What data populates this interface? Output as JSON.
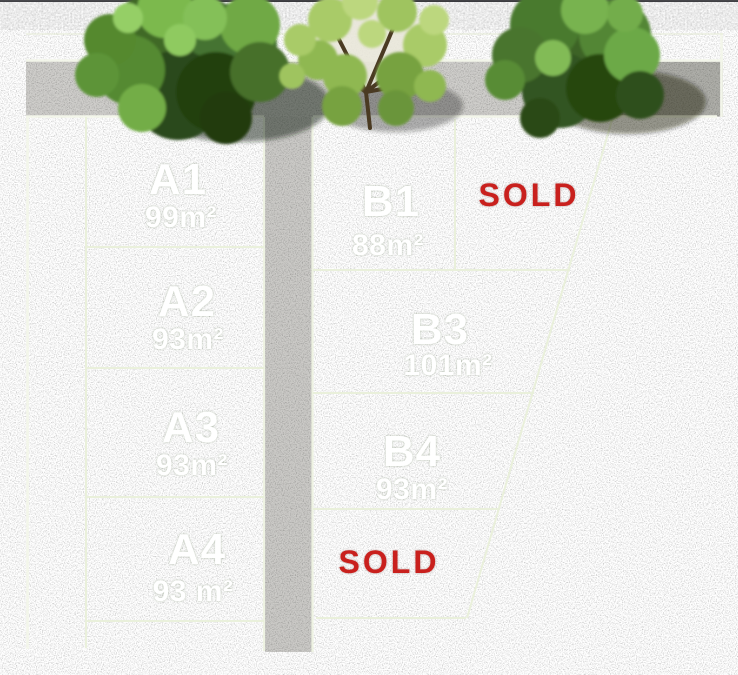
{
  "plan": {
    "description": "Land subdivision site plan",
    "lots": {
      "a1": {
        "name": "A1",
        "area": "99m²"
      },
      "a2": {
        "name": "A2",
        "area": "93m²"
      },
      "a3": {
        "name": "A3",
        "area": "93m²"
      },
      "a4": {
        "name": "A4",
        "area": "93 m²"
      },
      "b1": {
        "name": "B1",
        "area": "88m²"
      },
      "b3": {
        "name": "B3",
        "area": "101m²"
      },
      "b4": {
        "name": "B4",
        "area": "93m²"
      }
    },
    "sold_labels": {
      "top": "SOLD",
      "bottom": "SOLD"
    },
    "colors": {
      "grass": "#69a149",
      "road_gravel": "#cfcecb",
      "background": "#3a3a3e",
      "boundary_line": "#eef3e2",
      "lot_text": "#ffffff",
      "sold_text": "#c9201d"
    }
  }
}
